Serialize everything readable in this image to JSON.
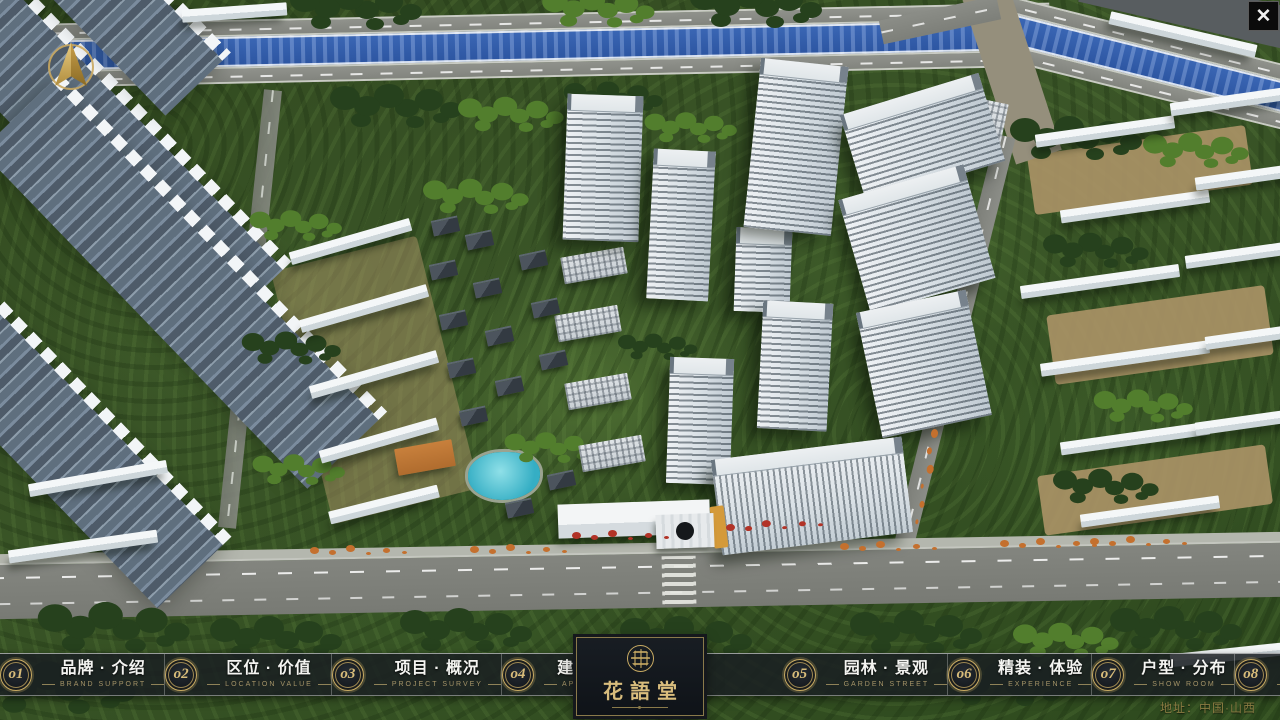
{
  "app": {
    "close_glyph": "✕",
    "address": "地址：中国·山西"
  },
  "logo": {
    "title": "花語堂"
  },
  "nav": {
    "items": [
      {
        "num": "o1",
        "zh": "品牌 · 介绍",
        "en": "BRAND SUPPORT"
      },
      {
        "num": "o2",
        "zh": "区位 · 价值",
        "en": "LOCATION VALUE"
      },
      {
        "num": "o3",
        "zh": "项目 · 概况",
        "en": "PROJECT SURVEY"
      },
      {
        "num": "o4",
        "zh": "建筑 · 鉴赏",
        "en": "APPRECIATION"
      },
      {
        "num": "o5",
        "zh": "园林 · 景观",
        "en": "GARDEN STREET"
      },
      {
        "num": "o6",
        "zh": "精装 · 体验",
        "en": "EXPERIENCE"
      },
      {
        "num": "o7",
        "zh": "户型 · 分布",
        "en": "SHOW ROOM"
      },
      {
        "num": "o8",
        "zh": "一房 · 一景",
        "en": "COMMUNITY"
      }
    ]
  },
  "colors": {
    "gold_accent": "#c9ab63",
    "bar_background": "rgba(26,30,34,0.85)",
    "river_blue": "#2d56a2",
    "address_gold": "#8a7b42"
  }
}
